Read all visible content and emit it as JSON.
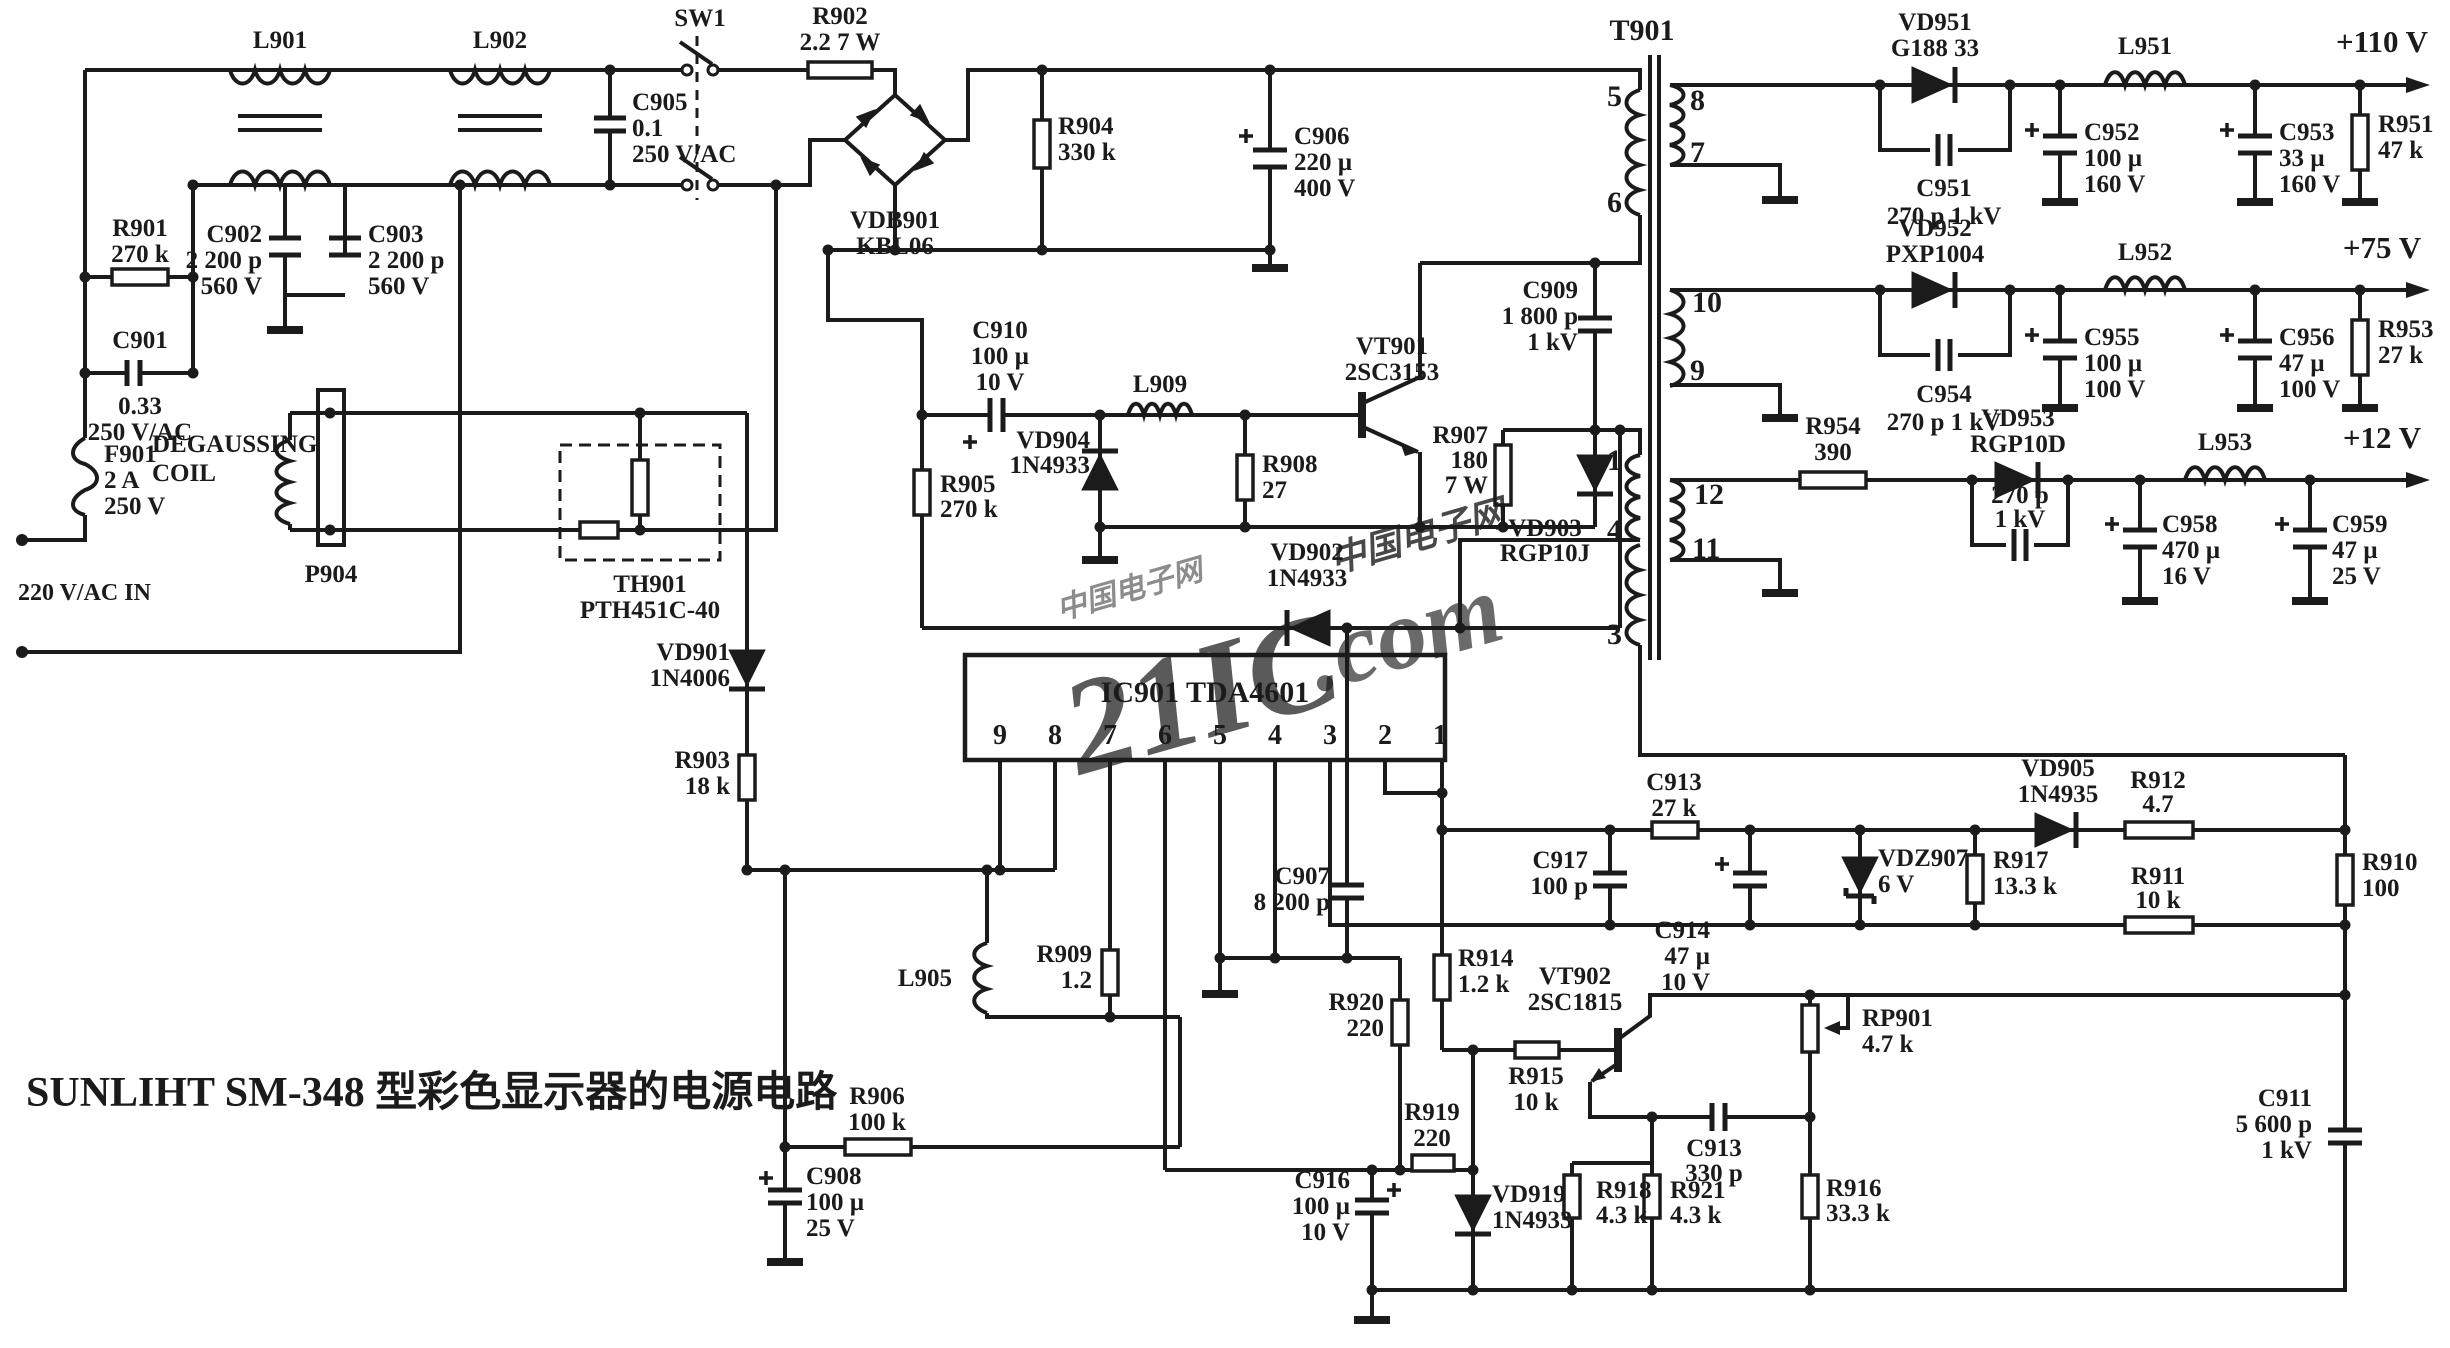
{
  "title": "SUNLIHT SM-348 型彩色显示器的电源电路",
  "labels": {
    "l901": [
      "L901"
    ],
    "l902": [
      "L902"
    ],
    "c905": [
      "C905",
      "0.1",
      "250 V/AC"
    ],
    "sw1": [
      "SW1"
    ],
    "r902": [
      "R902",
      "2.2 7 W"
    ],
    "vdb901": [
      "VDB901",
      "KBL06"
    ],
    "r904": [
      "R904",
      "330 k"
    ],
    "c906": [
      "C906",
      "220 µ",
      "400 V"
    ],
    "c902": [
      "C902",
      "2 200 p",
      "560 V"
    ],
    "c903": [
      "C903",
      "2 200 p",
      "560 V"
    ],
    "r901": [
      "R901",
      "270 k"
    ],
    "c901n": [
      "C901"
    ],
    "c901v": [
      "0.33",
      "250 V/AC"
    ],
    "f901": [
      "F901",
      "2 A",
      "250 V"
    ],
    "acin": [
      "220 V/AC IN"
    ],
    "degauss": [
      "DEGAUSSING",
      "COIL"
    ],
    "p904": [
      "P904"
    ],
    "th901": [
      "TH901",
      "PTH451C-40"
    ],
    "vd901": [
      "VD901",
      "1N4006"
    ],
    "r903": [
      "R903",
      "18 k"
    ],
    "c910": [
      "C910",
      "100 µ",
      "10 V"
    ],
    "r905": [
      "R905",
      "270 k"
    ],
    "vd904": [
      "VD904",
      "1N4933"
    ],
    "l909": [
      "L909"
    ],
    "r908": [
      "R908",
      "27"
    ],
    "vt901": [
      "VT901",
      "2SC3153"
    ],
    "r907": [
      "R907",
      "180",
      "7 W"
    ],
    "c909": [
      "C909",
      "1 800 p",
      "1 kV"
    ],
    "vd903": [
      "VD903",
      "RGP10J"
    ],
    "vd902": [
      "VD902",
      "1N4933"
    ],
    "t901": [
      "T901"
    ],
    "ic901": [
      "IC901  TDA4601"
    ],
    "p9": [
      "9"
    ],
    "p8": [
      "8"
    ],
    "p7": [
      "7"
    ],
    "p6": [
      "6"
    ],
    "p5": [
      "5"
    ],
    "p4": [
      "4"
    ],
    "p3": [
      "3"
    ],
    "p2": [
      "2"
    ],
    "p1": [
      "1"
    ],
    "tp5": [
      "5"
    ],
    "tp6": [
      "6"
    ],
    "tp1": [
      "1"
    ],
    "tp4": [
      "4"
    ],
    "tp3": [
      "3"
    ],
    "tp8": [
      "8"
    ],
    "tp7": [
      "7"
    ],
    "tp10": [
      "10"
    ],
    "tp9": [
      "9"
    ],
    "tp12": [
      "12"
    ],
    "tp11": [
      "11"
    ],
    "vd951": [
      "VD951",
      "G188 33"
    ],
    "c951": [
      "C951",
      "270 p  1 kV"
    ],
    "l951": [
      "L951"
    ],
    "c952": [
      "C952",
      "100 µ",
      "160 V"
    ],
    "c953": [
      "C953",
      "33 µ",
      "160 V"
    ],
    "r951": [
      "R951",
      "47 k"
    ],
    "out110": [
      "+110 V"
    ],
    "vd952": [
      "VD952",
      "PXP1004"
    ],
    "c954": [
      "C954",
      "270 p  1 kV"
    ],
    "l952": [
      "L952"
    ],
    "c955": [
      "C955",
      "100 µ",
      "100 V"
    ],
    "c956": [
      "C956",
      "47 µ",
      "100 V"
    ],
    "r953": [
      "R953",
      "27 k"
    ],
    "out75": [
      "+75 V"
    ],
    "r954": [
      "R954",
      "390"
    ],
    "vd953": [
      "VD953",
      "RGP10D"
    ],
    "c957": [
      "270 p",
      "1 kV"
    ],
    "l953": [
      "L953"
    ],
    "c958": [
      "C958",
      "470 µ",
      "16 V"
    ],
    "c959": [
      "C959",
      "47 µ",
      "25 V"
    ],
    "out12": [
      "+12 V"
    ],
    "l905": [
      "L905"
    ],
    "r909": [
      "R909",
      "1.2"
    ],
    "c907": [
      "C907",
      "8 200 p"
    ],
    "r906": [
      "R906",
      "100 k"
    ],
    "c908": [
      "C908",
      "100 µ",
      "25 V"
    ],
    "c913a": [
      "C913",
      "27 k"
    ],
    "c917": [
      "C917",
      "100 p"
    ],
    "c914": [
      "C914",
      "47 µ",
      "10 V"
    ],
    "vdz907": [
      "VDZ907",
      "6 V"
    ],
    "r917": [
      "R917",
      "13.3 k"
    ],
    "vd905": [
      "VD905",
      "1N4935"
    ],
    "r912": [
      "R912",
      "4.7"
    ],
    "r910": [
      "R910",
      "100"
    ],
    "r911": [
      "R911",
      "10 k"
    ],
    "r914": [
      "R914",
      "1.2 k"
    ],
    "r915": [
      "R915",
      "10 k"
    ],
    "vt902": [
      "VT902",
      "2SC1815"
    ],
    "rp901": [
      "RP901",
      "4.7 k"
    ],
    "r920": [
      "R920",
      "220"
    ],
    "r919": [
      "R919",
      "220"
    ],
    "c916": [
      "C916",
      "100 µ",
      "10 V"
    ],
    "vd919": [
      "VD919",
      "1N4933"
    ],
    "r918": [
      "R918",
      "4.3 k"
    ],
    "r921": [
      "R921",
      "4.3 k"
    ],
    "c913b": [
      "C913",
      "330 p"
    ],
    "r916": [
      "R916",
      "33.3 k"
    ],
    "c911": [
      "C911",
      "5 600 p",
      "1 kV"
    ]
  },
  "watermark": {
    "big": "21IC",
    "dot_com": ".com",
    "site": "中国电子网"
  },
  "colors": {
    "ink": "#1b1b1b",
    "paper": "#ffffff",
    "wm_red": "#e46a78",
    "wm_blue": "#8a9bd4"
  }
}
